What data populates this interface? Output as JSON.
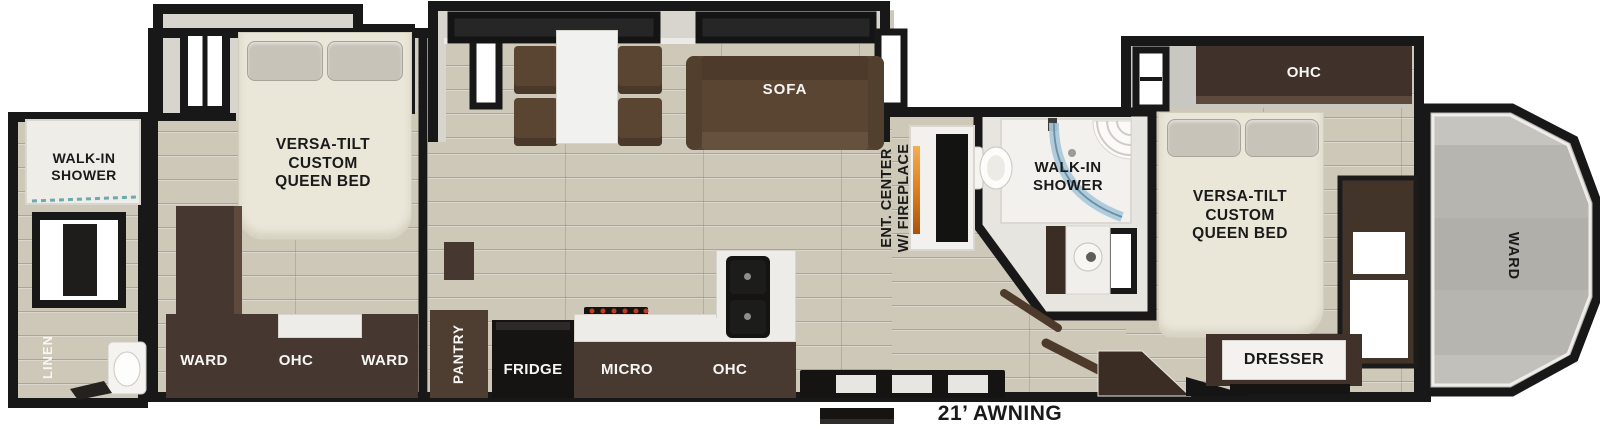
{
  "awning": {
    "label": "21’ AWNING"
  },
  "rear_bath": {
    "shower_label": "WALK-IN\nSHOWER",
    "linen_label": "LINEN"
  },
  "bedroom_rear": {
    "bed_label": "VERSA-TILT\nCUSTOM\nQUEEN BED",
    "ward_left_label": "WARD",
    "ohc_label": "OHC",
    "ward_right_label": "WARD"
  },
  "living": {
    "sofa_label": "SOFA",
    "ent_center_label": "ENT. CENTER\nW/ FIREPLACE"
  },
  "kitchen": {
    "pantry_label": "PANTRY",
    "fridge_label": "FRIDGE",
    "micro_label": "MICRO",
    "ohc_label": "OHC"
  },
  "mid_bath": {
    "shower_label": "WALK-IN\nSHOWER"
  },
  "bedroom_front": {
    "ohc_label": "OHC",
    "bed_label": "VERSA-TILT\nCUSTOM\nQUEEN BED",
    "dresser_label": "DRESSER"
  },
  "front_cap": {
    "ward_label": "WARD"
  },
  "colors": {
    "wall": "#1b1a19",
    "floor": "#cdc8b8",
    "bathfloor": "#e7e5e0",
    "cabinet": "#463830",
    "cabinetlight": "#5d4a3c",
    "sofa": "#5a4533",
    "bed": "#eae7d9",
    "pillow": "#c7c3b9",
    "counter": "#edece8",
    "appliance": "#151413",
    "glass": "#a9c8da",
    "fireplace": "#e08a2e",
    "cap": "#b7b5b0",
    "ink": "#1a1a1a"
  }
}
